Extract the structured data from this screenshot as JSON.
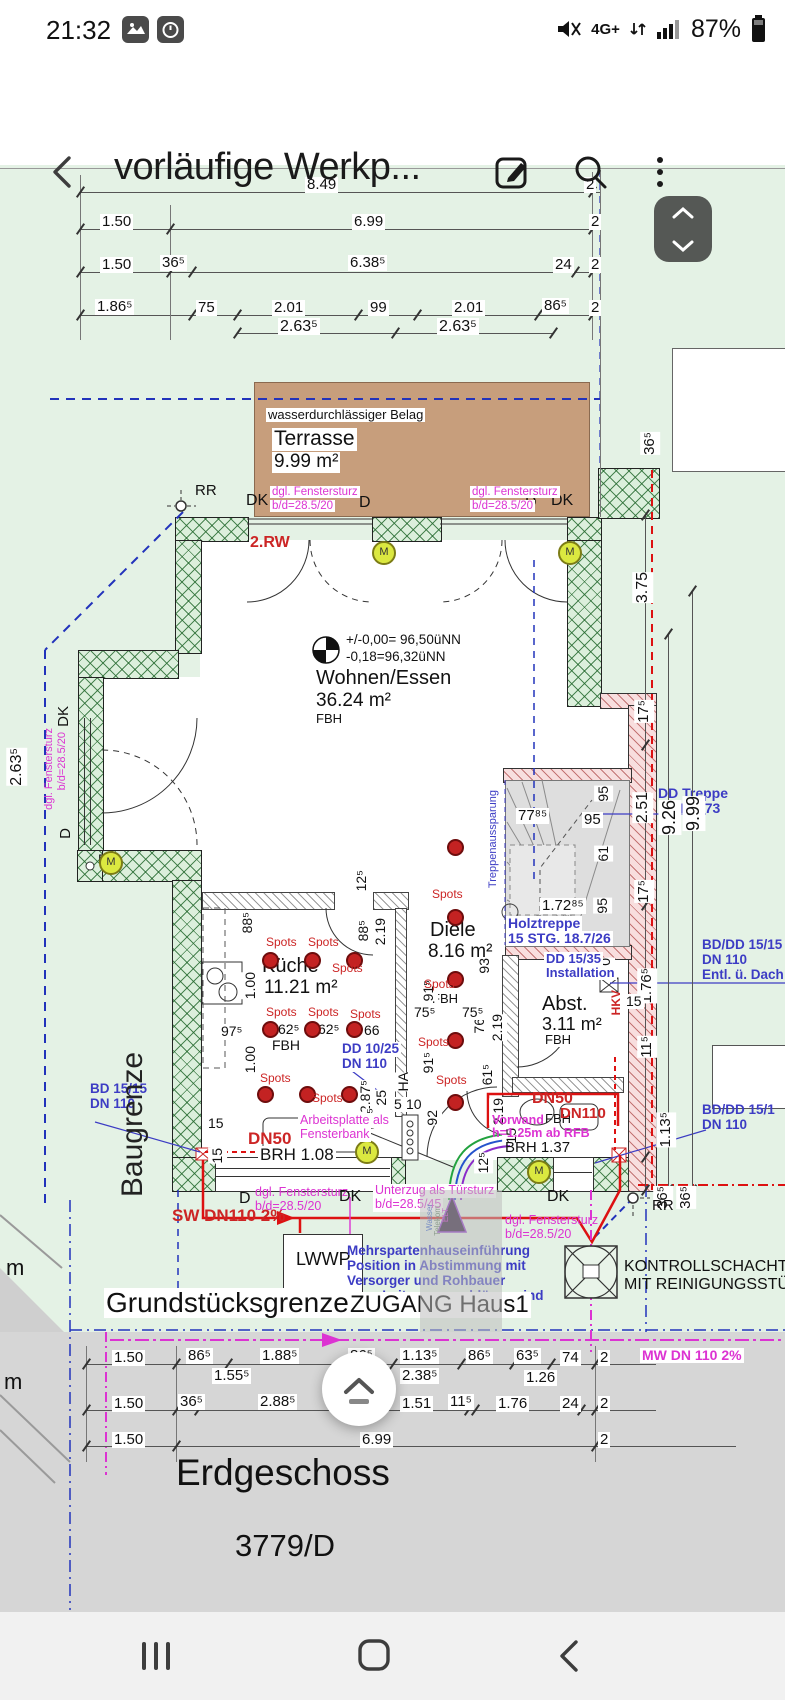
{
  "colors": {
    "accent_magenta": "#dc33d2",
    "annotation_blue": "#3c3cc4",
    "pipe_red": "#cc2525",
    "wall_green": "#24692e",
    "wall_pink": "#b25050",
    "terrace_brown": "#c79e7c",
    "bg_green": "#e4f2e5"
  },
  "status_bar": {
    "time": "21:32",
    "network": "4G+",
    "battery_pct": "87%",
    "mute_icon": "muted-speaker",
    "signal_icon": "signal-bars",
    "battery_icon": "battery"
  },
  "app_bar": {
    "title": "vorläufige Werkp..."
  },
  "plan": {
    "dims_top_r1": [
      "8.49",
      "2"
    ],
    "dims_top_r2": [
      "1.50",
      "6.99",
      "2"
    ],
    "dims_top_r3": [
      "1.50",
      "36⁵",
      "6.38⁵",
      "24",
      "2"
    ],
    "dims_top_r4": [
      "1.86⁵",
      "75",
      "2.01",
      "99",
      "2.01",
      "86⁵",
      "2"
    ],
    "dims_top_r4b": [
      "2.63⁵",
      "2.63⁵"
    ],
    "terrace": {
      "note": "wasserdurchlässiger Belag",
      "name": "Terrasse",
      "area": "9.99 m²"
    },
    "wall_labels": {
      "dk": "DK",
      "d": "D",
      "rw": "2.RW",
      "rr": "RR",
      "m": "M"
    },
    "lintel": {
      "l1": "dgl. Fenstersturz",
      "l2": "b/d=28.5/20"
    },
    "unterzug": {
      "l1": "Unterzug als Türsturz",
      "l2": "b/d=28.5/45"
    },
    "level": {
      "l1": "+/-0,00= 96,50üNN",
      "l2": "-0,18=96,32üNN"
    },
    "rooms": {
      "wohnen": {
        "name": "Wohnen/Essen",
        "area": "36.24 m²",
        "heat": "FBH"
      },
      "kueche": {
        "name": "Küche",
        "area": "11.21 m²",
        "heat": "FBH"
      },
      "diele": {
        "name": "Diele",
        "area": "8.16 m²",
        "heat": "FBH"
      },
      "abst": {
        "name": "Abst.",
        "area": "3.11 m²",
        "heat": "FBH"
      }
    },
    "bath_fbh": "FBH",
    "stair": {
      "aussparung": "Treppenaussparung",
      "dd1": "DD Treppe",
      "dd2": "2,51x1,73",
      "holz1": "Holztreppe",
      "holz2": "15 STG. 18.7/26"
    },
    "stair_dims": [
      "77⁸⁵",
      "95",
      "95",
      "61",
      "1.72⁸⁵",
      "95"
    ],
    "right_dims": [
      "36⁵",
      "3.75",
      "17⁵",
      "2.51",
      "9.26",
      "9.99",
      "17⁵",
      "1.76⁵",
      "11⁵",
      "1.13⁵",
      "36⁵",
      "36⁵"
    ],
    "left_dims": {
      "d263": "2.63⁵",
      "dk": "DK",
      "d": "D"
    },
    "misc_dims": [
      "88⁵",
      "1.00",
      "1.00",
      "97⁵",
      "62⁵",
      "62⁵",
      "66",
      "12⁵",
      "88⁵",
      "2.19",
      "2.87⁵",
      "93",
      "76",
      "2.19",
      "61⁵",
      "2.19",
      "75⁵",
      "75⁵",
      "91⁵",
      "91⁵",
      "60⁵",
      "25",
      "5",
      "10",
      "92",
      "15",
      "15",
      "50",
      "15",
      "15",
      "12⁵"
    ],
    "notes_blue": {
      "bd_left1": "BD 15/15",
      "bd_left2": "DN 110",
      "dd_kitchen1": "DD 10/25",
      "dd_kitchen2": "DN 110",
      "dd_inst1": "DD 15/35",
      "dd_inst2": "Installation",
      "bddd_top1": "BD/DD 15/15",
      "bddd_top2": "DN 110",
      "bddd_top3": "Entl. ü. Dach",
      "bddd_bot1": "BD/DD 15/1",
      "bddd_bot2": "DN 110"
    },
    "notes_red": {
      "dn50a": "DN50",
      "dn50b": "DN50",
      "dn110": "DN110",
      "sw": "SW DN110 2%",
      "hkv": "HKV",
      "spots": "Spots"
    },
    "notes_mag": {
      "arb1": "Arbeitsplatte als",
      "arb2": "Fensterbank",
      "vor1": "Vorwand",
      "vor2": "h=1.25m ab RFB",
      "mw": "MW DN 110 2%"
    },
    "brh": {
      "a": "BRH 1.08",
      "b": "BRH 1.37"
    },
    "ha": "HA",
    "mehrsparten": [
      "Mehrspartenhauseinführung",
      "Position in Abstimmung mit",
      "Versorger und Rohbauer",
      "Lage Leitungsanschlüsse sind",
      "vor Ort zu lokalisieren"
    ],
    "utilities": [
      "Wasser",
      "Telekom",
      "ELT"
    ],
    "site": {
      "baugrenze": "Baugrenze",
      "grenze": "Grundstücksgrenze",
      "zugang": "ZUGANG Haus1",
      "lwwp": "LWWP",
      "kontroll1": "KONTROLLSCHACHT",
      "kontroll2": "MIT REINIGUNGSSTÜCK",
      "m1": "m",
      "m2": "m"
    },
    "dims_bottom_r1": [
      "1.50",
      "86⁵",
      "1.88⁵",
      "86⁵",
      "1.13⁵",
      "86⁵",
      "63⁵",
      "74",
      "2"
    ],
    "dims_bottom_r1b": [
      "1.55⁵",
      "2.38⁵",
      "1.26"
    ],
    "dims_bottom_r2": [
      "1.50",
      "36⁵",
      "2.88⁵",
      "11⁵",
      "1.51",
      "11⁵",
      "1.76",
      "24",
      "2"
    ],
    "dims_bottom_r3": [
      "1.50",
      "6.99",
      "2"
    ],
    "footer": {
      "floor": "Erdgeschoss",
      "parcel": "3779/D"
    }
  }
}
